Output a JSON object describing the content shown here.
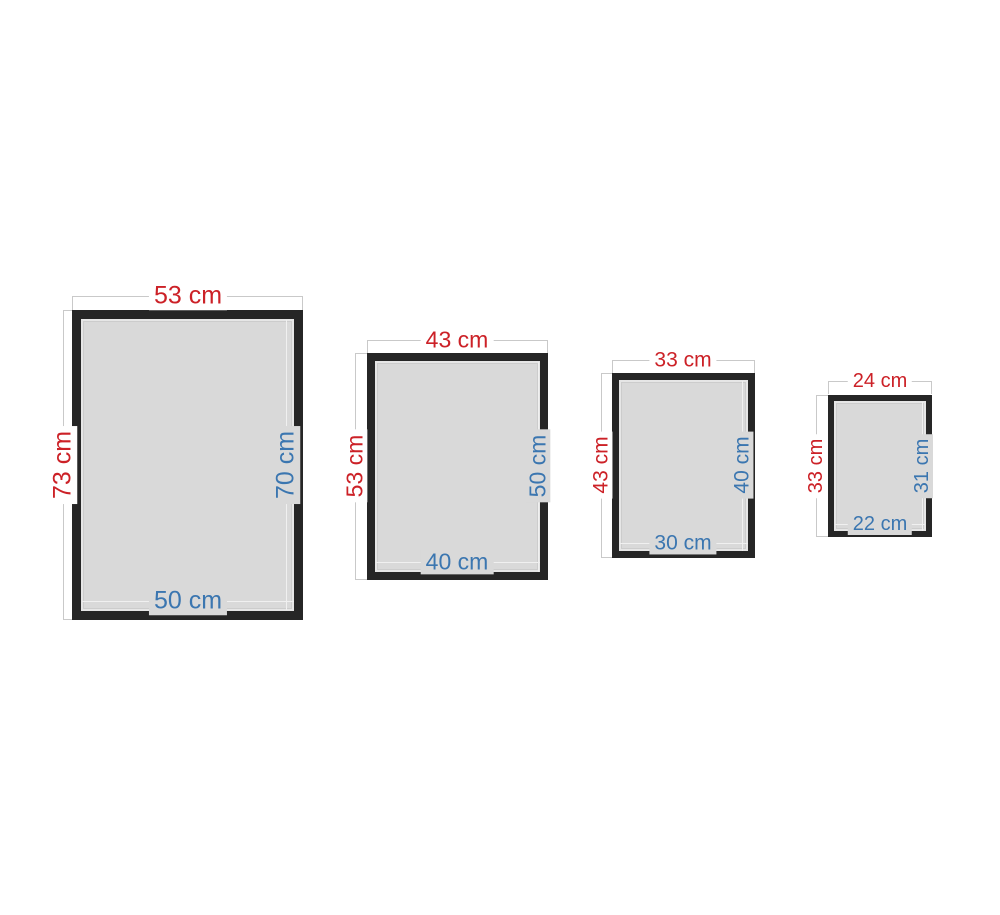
{
  "frames": [
    {
      "outer_width": "53 cm",
      "outer_height": "73 cm",
      "inner_height": "70 cm",
      "inner_width": "50 cm"
    },
    {
      "outer_width": "43 cm",
      "outer_height": "53 cm",
      "inner_height": "50 cm",
      "inner_width": "40 cm"
    },
    {
      "outer_width": "33 cm",
      "outer_height": "43 cm",
      "inner_height": "40 cm",
      "inner_width": "30 cm"
    },
    {
      "outer_width": "24 cm",
      "outer_height": "33 cm",
      "inner_height": "31 cm",
      "inner_width": "22 cm"
    }
  ],
  "units": "cm",
  "colors": {
    "outer_dimension_text": "#cc2127",
    "inner_dimension_text": "#3b76b0",
    "frame": "#262626",
    "frame_interior": "#d9d9d9",
    "dimension_line": "#c9c9c9",
    "inner_dimension_line": "#f0f0f0",
    "background": "#ffffff"
  }
}
